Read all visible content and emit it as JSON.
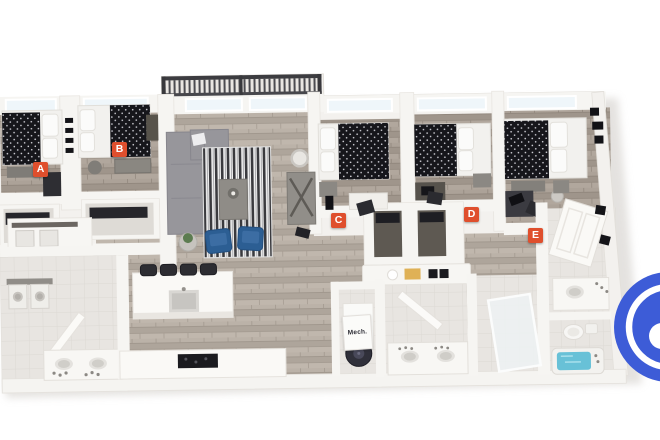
{
  "floor_plan": {
    "room_labels": [
      {
        "letter": "A"
      },
      {
        "letter": "B"
      },
      {
        "letter": "C"
      },
      {
        "letter": "D"
      },
      {
        "letter": "E"
      }
    ],
    "mech_closet_label": "Mech.",
    "label_color": "#DF4F2D",
    "label_text_color": "#FFFFFF"
  },
  "branding": {
    "logo_color": "#3D5CD7",
    "logo_ring_color": "#FFFFFF"
  }
}
